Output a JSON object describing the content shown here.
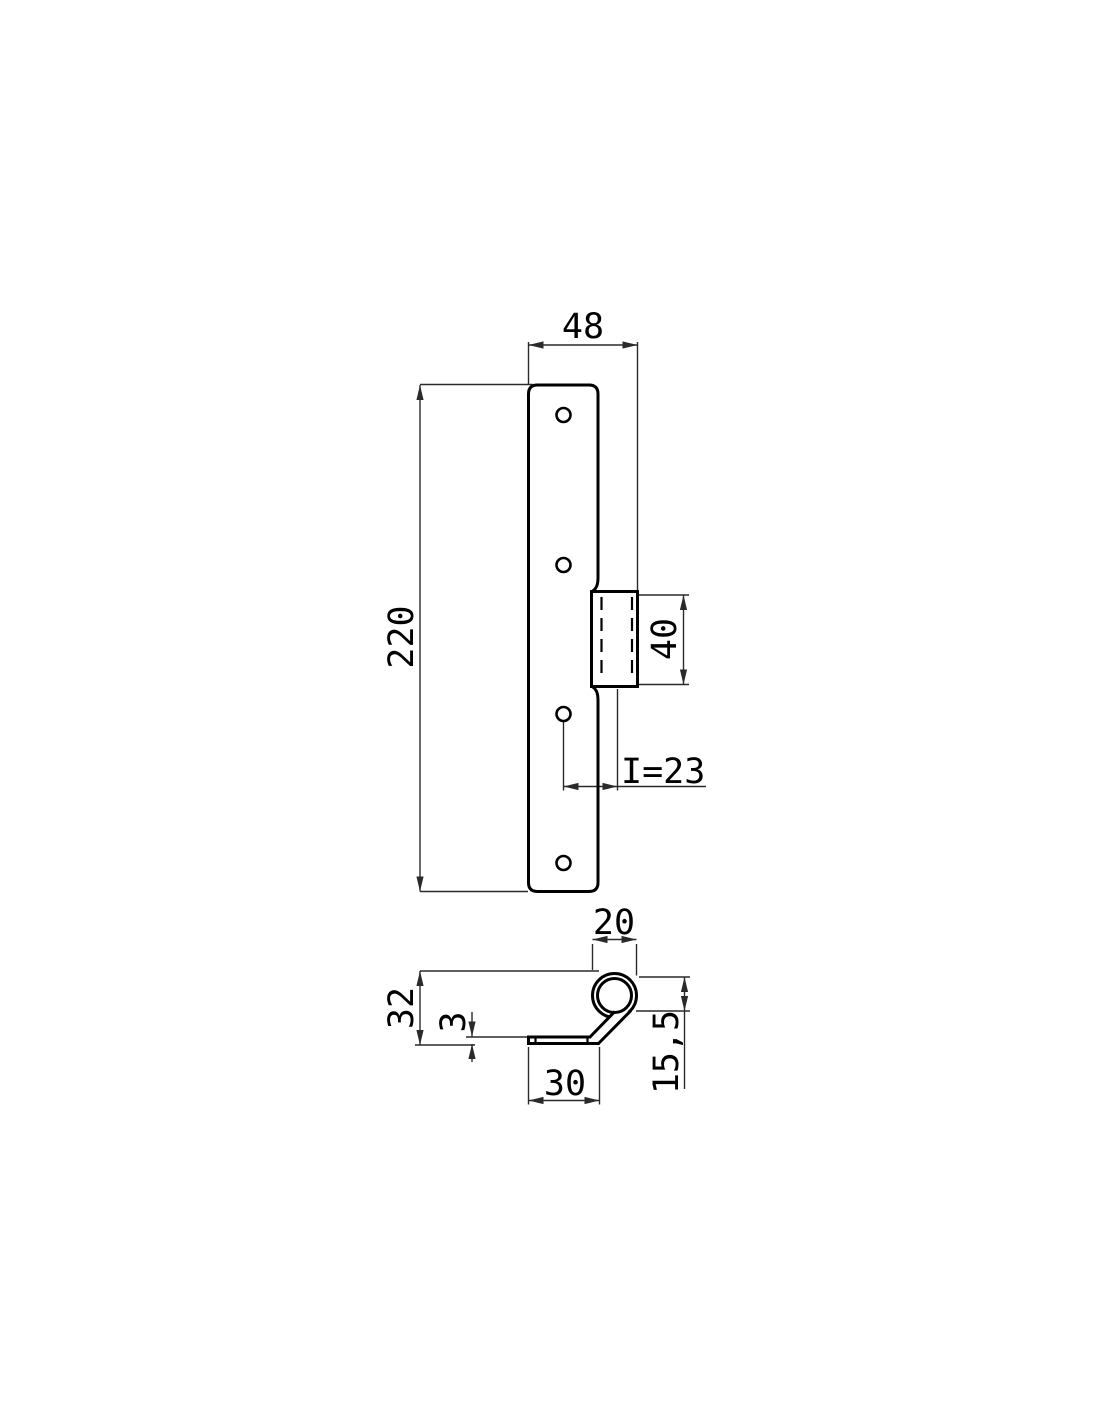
{
  "drawing": {
    "title": "hinge-technical-drawing",
    "colors": {
      "outline": "#000000",
      "dimension_line": "#2a2a2a",
      "background": "#ffffff"
    },
    "front": {
      "dim_width": "48",
      "dim_height": "220",
      "dim_knuckle": "40",
      "dim_offset": "I=23",
      "hole_count": 4
    },
    "section": {
      "dim_curl_width": "20",
      "dim_height": "32",
      "dim_thickness": "3",
      "dim_leaf": "30",
      "dim_curl_inner": "15,5"
    }
  }
}
